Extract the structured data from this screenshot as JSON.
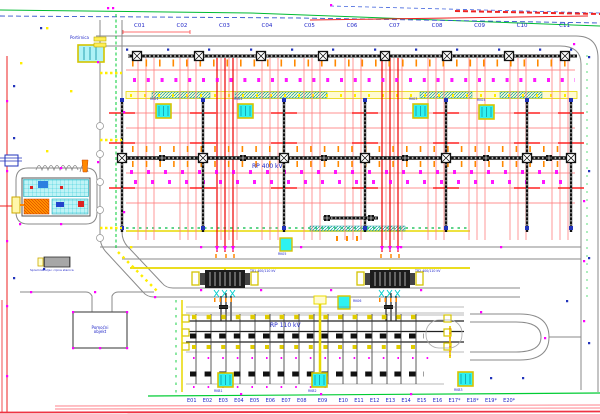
{
  "site": {
    "rp400_label": "RP 400 kV",
    "rp110_label": "RP 110 kV",
    "top_bays": [
      "C01",
      "C02",
      "C03",
      "C04",
      "C05",
      "C06",
      "C07",
      "C08",
      "C09",
      "C10",
      "C11"
    ],
    "bottom_bays": [
      "E01",
      "E02",
      "E03",
      "E04",
      "E05",
      "E06",
      "E07",
      "E08",
      "E09",
      "E10",
      "E11",
      "E12",
      "E13",
      "E14",
      "E15",
      "E16",
      "E17*",
      "E18*",
      "E19*",
      "E20*"
    ]
  },
  "buildings": {
    "gatehouse_label": "Portirnica",
    "aux_building_line1": "Pomoćni",
    "aux_building_line2": "objekt",
    "oil_station_label": "Spremnik ulja i crpna stanica"
  },
  "equipment": {
    "kiosks_400": [
      "RK01",
      "RK02",
      "RK03",
      "RK04"
    ],
    "kiosks_mid": [
      "RK05",
      "RK06"
    ],
    "kiosks_110": [
      "RKB1",
      "RKB2",
      "RKB3"
    ],
    "transformer_labels": [
      "TR1 400/110 kV",
      "TR2 400/110 kV"
    ]
  },
  "colors": {
    "busbar_black": "#111111",
    "conductor_red": "#ff8888",
    "conductor_bright_red": "#ff2222",
    "fence_green": "#00cc33",
    "trench_yellow": "#e8d800",
    "kiosk_cyan": "#2ef2f2",
    "marker_magenta": "#ff00ff",
    "marker_blue": "#2233bb",
    "label_blue": "#2026c8",
    "insulator_orange": "#ff8800",
    "road_gray": "#8a8a8a",
    "hatch_teal": "#00a0a0"
  }
}
